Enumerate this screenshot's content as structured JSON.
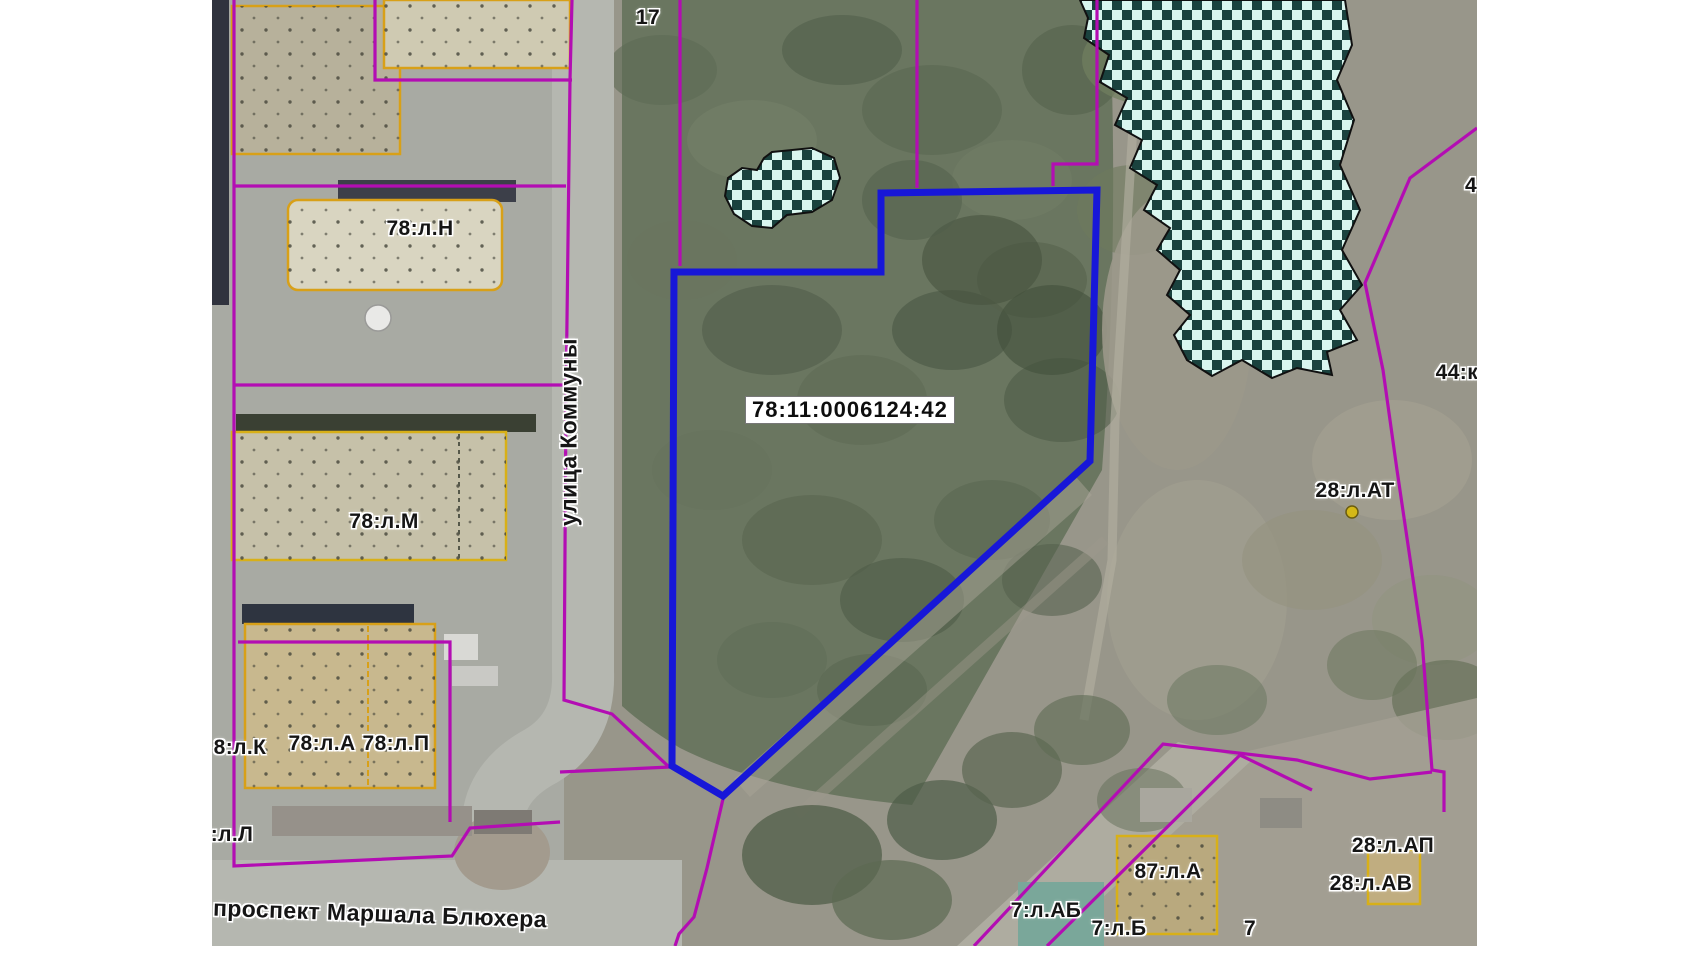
{
  "map": {
    "selected_parcel": {
      "cadastral_number": "78:11:0006124:42",
      "outline_color": "#1717d8",
      "polygon": [
        [
          669,
          193
        ],
        [
          885,
          190
        ],
        [
          878,
          461
        ],
        [
          511,
          796
        ],
        [
          460,
          766
        ],
        [
          462,
          272
        ],
        [
          669,
          272
        ]
      ]
    },
    "colors": {
      "parcel_line": "#b30db3",
      "building_outline": "#d8a018",
      "checker_dark": "#1a423e",
      "checker_light": "#d9f6ef",
      "marker": "#d4b818",
      "label_halo": "#ffffff",
      "label_text": "#151515"
    },
    "labels": [
      {
        "name": "parcel-label-17",
        "text": "17",
        "x": 436,
        "y": 18
      },
      {
        "name": "parcel-label-78lN",
        "text": "78:л.Н",
        "x": 208,
        "y": 229
      },
      {
        "name": "parcel-label-78lM",
        "text": "78:л.М",
        "x": 172,
        "y": 522
      },
      {
        "name": "parcel-label-8lK",
        "text": "8:л.К",
        "x": 28,
        "y": 748
      },
      {
        "name": "parcel-label-78lA",
        "text": "78:л.А",
        "x": 110,
        "y": 744
      },
      {
        "name": "parcel-label-78lP",
        "text": "78:л.П",
        "x": 184,
        "y": 744
      },
      {
        "name": "parcel-label-8lL",
        "text": "8:л.Л",
        "x": 14,
        "y": 835
      },
      {
        "name": "parcel-label-28lAT",
        "text": "28:л.АТ",
        "x": 1143,
        "y": 491
      },
      {
        "name": "parcel-label-4",
        "text": "4",
        "x": 1259,
        "y": 186
      },
      {
        "name": "parcel-label-44k",
        "text": "44:к.",
        "x": 1248,
        "y": 373
      },
      {
        "name": "parcel-label-28lAP",
        "text": "28:л.АП",
        "x": 1181,
        "y": 846
      },
      {
        "name": "parcel-label-28lAV",
        "text": "28:л.АВ",
        "x": 1159,
        "y": 884
      },
      {
        "name": "parcel-label-87lA",
        "text": "87:л.А",
        "x": 956,
        "y": 872
      },
      {
        "name": "parcel-label-7lAB",
        "text": "7:л.АБ",
        "x": 834,
        "y": 911
      },
      {
        "name": "parcel-label-7lB",
        "text": "7:л.Б",
        "x": 907,
        "y": 929
      },
      {
        "name": "parcel-label-7",
        "text": "7",
        "x": 1038,
        "y": 929
      }
    ],
    "street_labels": [
      {
        "name": "street-label-ulitsa-kommuny",
        "text": "улица Коммуны",
        "x": 357,
        "y": 432,
        "rotate": -90
      },
      {
        "name": "street-label-prospekt-marshala-blyukhera",
        "text": "проспект Маршала Блюхера",
        "x": 168,
        "y": 914,
        "rotate": 2
      }
    ],
    "checkered_zones": [
      {
        "name": "checkered-zone-lake",
        "path": "M868,0 L1133,0 L1140,45 L1125,80 L1142,120 L1128,165 L1148,210 L1130,250 L1150,285 L1128,310 L1145,340 L1115,352 L1120,375 L1085,368 L1060,378 L1030,360 L1000,376 L975,360 L962,335 L978,315 L955,295 L968,270 L945,250 L958,228 L932,210 L945,185 L918,168 L930,140 L903,125 L915,98 L888,82 L897,55 L872,38 L876,18 Z"
      },
      {
        "name": "checkered-zone-pond",
        "path": "M560,152 L600,148 L622,158 L628,178 L620,200 L600,212 L575,215 L560,228 L540,226 L522,214 L513,196 L516,178 L530,168 L545,170 L552,158 Z"
      }
    ],
    "parcel_lines": [
      [
        [
          22,
          0
        ],
        [
          22,
          866
        ],
        [
          240,
          856
        ],
        [
          258,
          828
        ],
        [
          348,
          822
        ]
      ],
      [
        [
          22,
          186
        ],
        [
          354,
          186
        ]
      ],
      [
        [
          163,
          0
        ],
        [
          163,
          80
        ],
        [
          360,
          80
        ]
      ],
      [
        [
          360,
          0
        ],
        [
          358,
          80
        ],
        [
          354,
          400
        ],
        [
          352,
          700
        ],
        [
          400,
          714
        ],
        [
          456,
          766
        ]
      ],
      [
        [
          22,
          385
        ],
        [
          354,
          385
        ]
      ],
      [
        [
          26,
          642
        ],
        [
          238,
          642
        ],
        [
          238,
          822
        ]
      ],
      [
        [
          468,
          0
        ],
        [
          468,
          266
        ]
      ],
      [
        [
          705,
          0
        ],
        [
          705,
          188
        ]
      ],
      [
        [
          885,
          0
        ],
        [
          885,
          164
        ],
        [
          841,
          164
        ],
        [
          841,
          186
        ]
      ],
      [
        [
          1265,
          128
        ],
        [
          1198,
          178
        ],
        [
          1153,
          283
        ],
        [
          1171,
          370
        ],
        [
          1185,
          470
        ],
        [
          1210,
          640
        ],
        [
          1220,
          770
        ],
        [
          1232,
          772
        ],
        [
          1232,
          812
        ]
      ],
      [
        [
          762,
          946
        ],
        [
          951,
          744
        ],
        [
          1085,
          760
        ],
        [
          1158,
          779
        ],
        [
          1220,
          772
        ]
      ],
      [
        [
          835,
          946
        ],
        [
          1028,
          755
        ],
        [
          1100,
          790
        ]
      ],
      [
        [
          511,
          799
        ],
        [
          495,
          868
        ],
        [
          482,
          917
        ],
        [
          467,
          934
        ],
        [
          463,
          946
        ]
      ],
      [
        [
          348,
          772
        ],
        [
          458,
          767
        ]
      ]
    ],
    "buildings": [
      {
        "name": "building-dark-strip",
        "x": 0,
        "y": 0,
        "w": 17,
        "h": 305,
        "fill": "#30333e"
      },
      {
        "name": "building-pad-west",
        "x": 20,
        "y": 6,
        "w": 168,
        "h": 148,
        "fill": "#b7b19b",
        "outline": "#d8a018",
        "dots": true
      },
      {
        "name": "building-17",
        "x": 172,
        "y": 0,
        "w": 186,
        "h": 68,
        "fill": "#cfcab2",
        "outline": "#d8a018",
        "dots": true
      },
      {
        "name": "roof-strip-78lN",
        "x": 126,
        "y": 180,
        "w": 178,
        "h": 22,
        "fill": "#3c3f49"
      },
      {
        "name": "building-78lN",
        "x": 76,
        "y": 200,
        "w": 214,
        "h": 90,
        "fill": "#d9d5c1",
        "outline": "#d8a018",
        "dots": true,
        "rx": 10
      },
      {
        "name": "tank",
        "type": "circle",
        "x": 166,
        "y": 318,
        "r": 13,
        "fill": "#e9e9e7",
        "outline": "#9a9a98"
      },
      {
        "name": "roof-strip-78lM",
        "x": 24,
        "y": 414,
        "w": 300,
        "h": 18,
        "fill": "#3a4033"
      },
      {
        "name": "building-78lM",
        "x": 20,
        "y": 432,
        "w": 274,
        "h": 128,
        "fill": "#c6c1a9",
        "outline": "#d8b018",
        "dots": true
      },
      {
        "name": "roof-strip-78lA",
        "x": 30,
        "y": 604,
        "w": 172,
        "h": 20,
        "fill": "#2e3440"
      },
      {
        "name": "building-78lA-78lP",
        "x": 33,
        "y": 624,
        "w": 190,
        "h": 164,
        "fill": "#c8b88e",
        "outline": "#d8a018",
        "dots": true
      },
      {
        "name": "shed-1",
        "x": 232,
        "y": 634,
        "w": 34,
        "h": 26,
        "fill": "#d9d9d5"
      },
      {
        "name": "shed-2",
        "x": 240,
        "y": 666,
        "w": 46,
        "h": 20,
        "fill": "#c9c9c5"
      },
      {
        "name": "prospekt-row-west",
        "x": 60,
        "y": 806,
        "w": 200,
        "h": 30,
        "fill": "#96918a"
      },
      {
        "name": "prospekt-row-east",
        "x": 262,
        "y": 810,
        "w": 58,
        "h": 24,
        "fill": "#7e7a74"
      },
      {
        "name": "building-87lA",
        "x": 905,
        "y": 836,
        "w": 100,
        "h": 98,
        "fill": "#b9a97e",
        "outline": "#d8b018",
        "dots": true
      },
      {
        "name": "building-teal-roof",
        "x": 806,
        "y": 882,
        "w": 86,
        "h": 64,
        "fill": "#7aa79a"
      },
      {
        "name": "building-28lAP",
        "x": 1156,
        "y": 850,
        "w": 52,
        "h": 54,
        "fill": "#c0ad80",
        "outline": "#d8b018"
      },
      {
        "name": "shed-right-1",
        "x": 1048,
        "y": 798,
        "w": 42,
        "h": 30,
        "fill": "#8e8c84"
      },
      {
        "name": "shed-right-2",
        "x": 928,
        "y": 788,
        "w": 52,
        "h": 34,
        "fill": "#a9a79e"
      }
    ],
    "dividers": [
      {
        "x1": 247,
        "y1": 434,
        "x2": 247,
        "y2": 558,
        "color": "#55584a",
        "dash": "4 4"
      },
      {
        "x1": 156,
        "y1": 626,
        "x2": 156,
        "y2": 786,
        "color": "#d8a018",
        "dash": "6 3"
      }
    ],
    "markers": [
      {
        "name": "point-marker",
        "x": 1140,
        "y": 512,
        "r": 6
      }
    ]
  }
}
